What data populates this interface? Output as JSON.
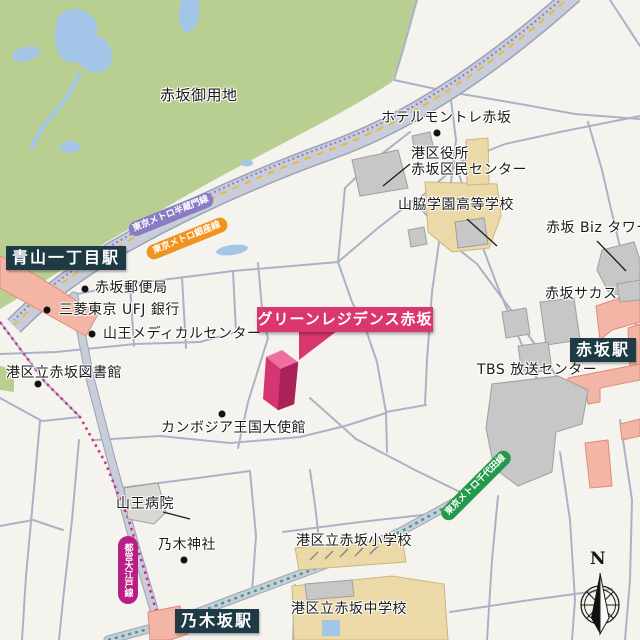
{
  "areas": {
    "imperial_grounds": "赤坂御用地"
  },
  "stations": [
    {
      "name": "青山一丁目駅"
    },
    {
      "name": "乃木坂駅"
    },
    {
      "name": "赤坂駅"
    }
  ],
  "rail_lines": [
    {
      "name": "東京メトロ半蔵門線",
      "color": "#8a7cc4"
    },
    {
      "name": "東京メトロ銀座線",
      "color": "#f0941f"
    },
    {
      "name": "都営大江戸線",
      "color": "#b81e85"
    },
    {
      "name": "東京メトロ千代田線",
      "color": "#23994c"
    }
  ],
  "pois": {
    "hotel_monterey": "ホテルモントレ赤坂",
    "ward_office_line1": "港区役所",
    "ward_office_line2": "赤坂区民センター",
    "yamawaki_school": "山脇学園高等学校",
    "biz_tower": "赤坂 Biz タワー",
    "sacas": "赤坂サカス",
    "tbs": "TBS 放送センター",
    "post_office": "赤坂郵便局",
    "ufj_bank": "三菱東京 UFJ 銀行",
    "sanno_medical": "山王メディカルセンター",
    "library": "港区立赤坂図書館",
    "embassy": "カンボジア王国大使館",
    "sanno_hospital": "山王病院",
    "nogi_shrine": "乃木神社",
    "elementary_school": "港区立赤坂小学校",
    "junior_high_school": "港区立赤坂中学校"
  },
  "callout": {
    "label": "グリーンレジデンス赤坂",
    "color": "#d9376e"
  },
  "compass": {
    "north": "N"
  },
  "colors": {
    "background": "#f4f3ee",
    "park": "#b9cf92",
    "water": "#a3c6e8",
    "road_fill": "#c9cdd9",
    "street_line": "#aab3c6",
    "building_gray": "#c7c7c7",
    "school_ground_tan": "#ecd9a8",
    "station_area_salmon": "#f3b5a5",
    "station_badge": "#1e3a44",
    "highlight_pink": "#d9376e"
  }
}
